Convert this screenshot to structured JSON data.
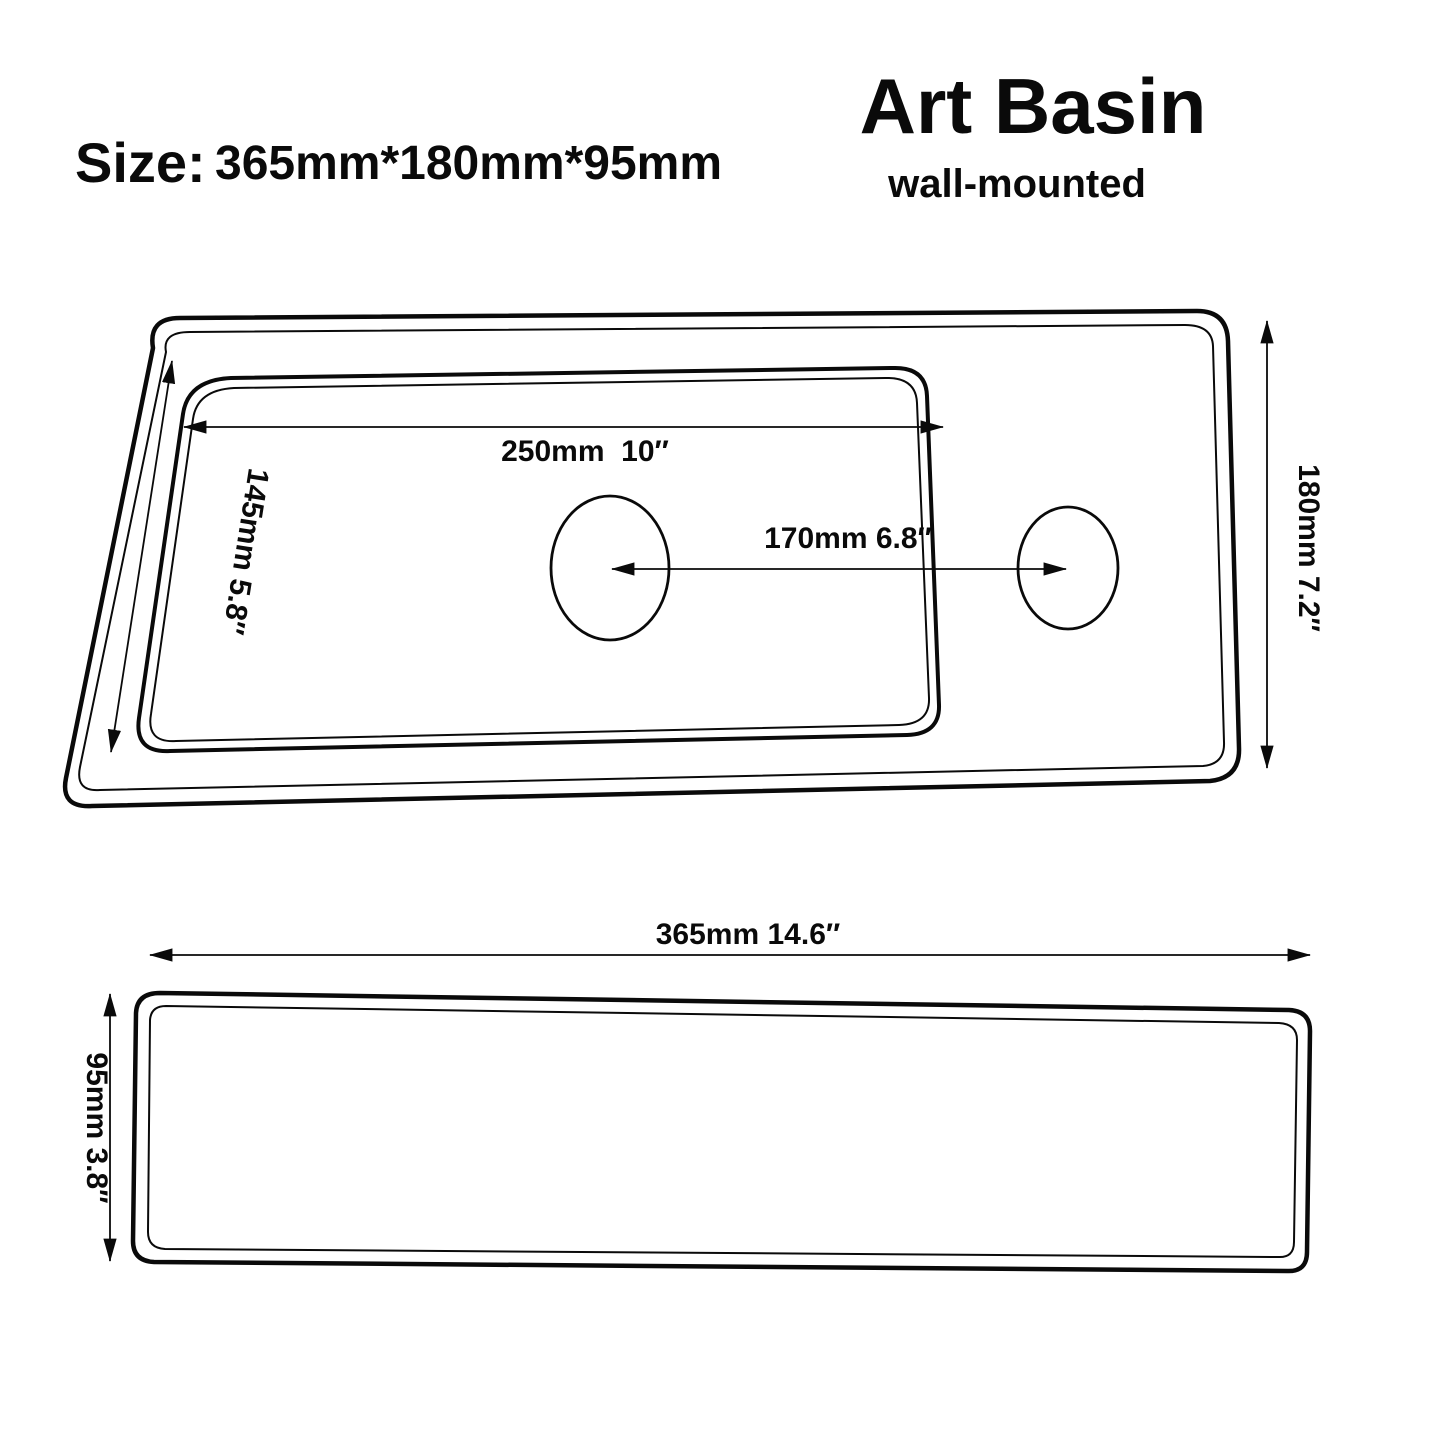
{
  "header": {
    "size_label": "Size:",
    "size_value": "365mm*180mm*95mm",
    "title": "Art Basin",
    "subtitle": "wall-mounted"
  },
  "top_view": {
    "view_name": "top view",
    "labels": {
      "basin_width": "250mm  10″",
      "basin_depth": "145mm 5.8″",
      "hole_spacing": "170mm 6.8″",
      "overall_depth": "180mm 7.2″"
    }
  },
  "side_view": {
    "view_name": "side view",
    "labels": {
      "overall_width": "365mm 14.6″",
      "overall_height": "95mm 3.8″"
    }
  },
  "colors": {
    "line": "#0a0a0a",
    "background": "#ffffff"
  }
}
